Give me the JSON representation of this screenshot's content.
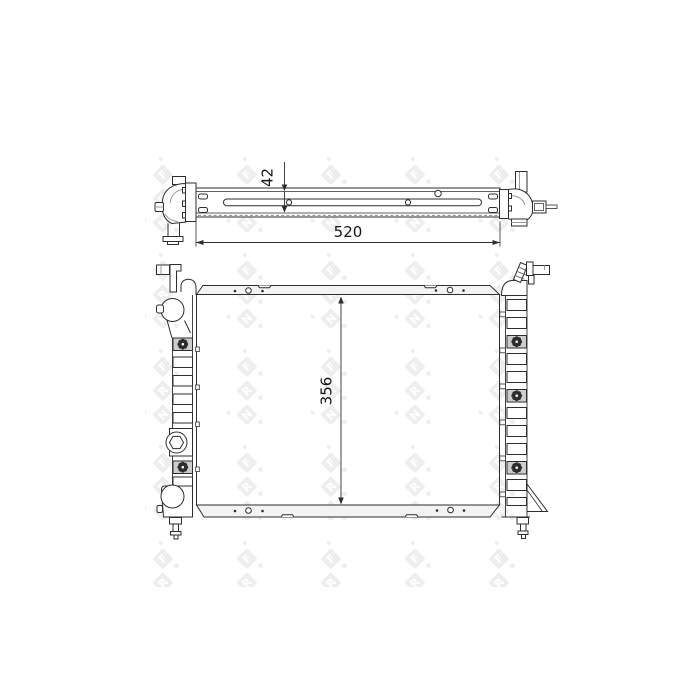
{
  "watermark": {
    "brand_letters": [
      "N",
      "R",
      "F"
    ]
  },
  "dimensions": {
    "top_width": "520",
    "top_depth": "42",
    "front_height": "356"
  },
  "colors": {
    "line": "#2e2e2e",
    "shade": "#cdcdcd",
    "header_fill": "#f3f3f3",
    "watermark": "#e2e2e2",
    "background": "#ffffff"
  }
}
